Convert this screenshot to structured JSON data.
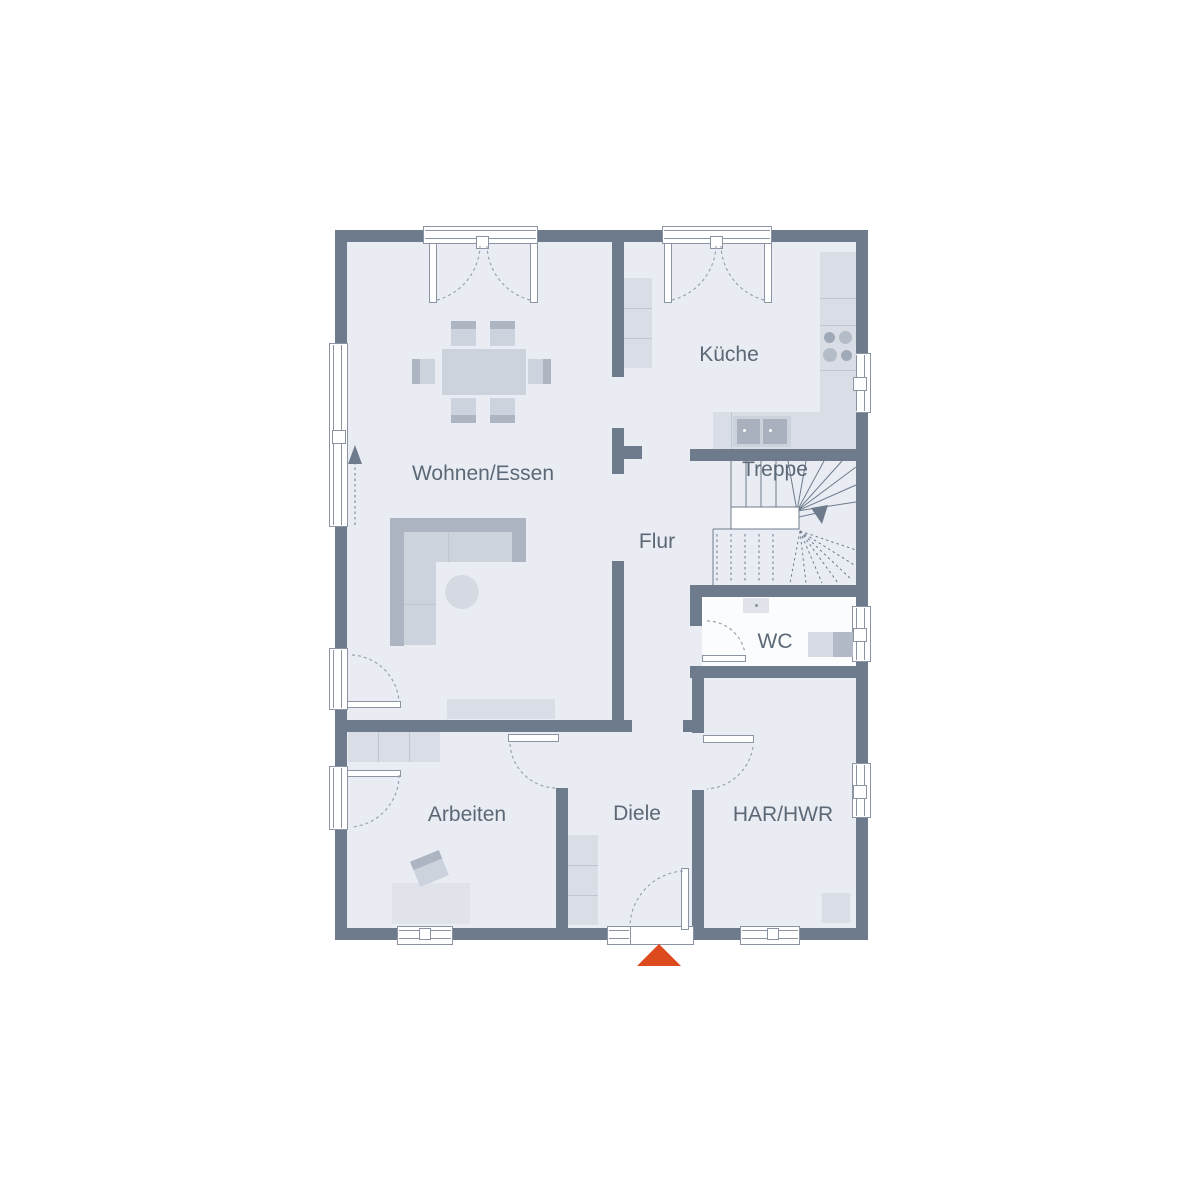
{
  "plan": {
    "type": "floor-plan",
    "rooms": [
      {
        "id": "wohnen-essen",
        "label": "Wohnen/Essen"
      },
      {
        "id": "kueche",
        "label": "Küche"
      },
      {
        "id": "treppe",
        "label": "Treppe"
      },
      {
        "id": "flur",
        "label": "Flur"
      },
      {
        "id": "wc",
        "label": "WC"
      },
      {
        "id": "arbeiten",
        "label": "Arbeiten"
      },
      {
        "id": "diele",
        "label": "Diele"
      },
      {
        "id": "har-hwr",
        "label": "HAR/HWR"
      }
    ]
  },
  "colors": {
    "background": "#ffffff",
    "wall": "#6e7b8c",
    "floor": "#e9edf3",
    "wc_floor": "#fbfcfe",
    "furniture_light": "#d9dde6",
    "furniture_mid": "#cdd3dd",
    "furniture_dark": "#aeb5c2",
    "desk": "#e0e4ea",
    "window_frame": "#8a94a3",
    "line": "#6e7b8c",
    "label_text": "#5c6876",
    "entrance_marker": "#dd4a1e"
  }
}
